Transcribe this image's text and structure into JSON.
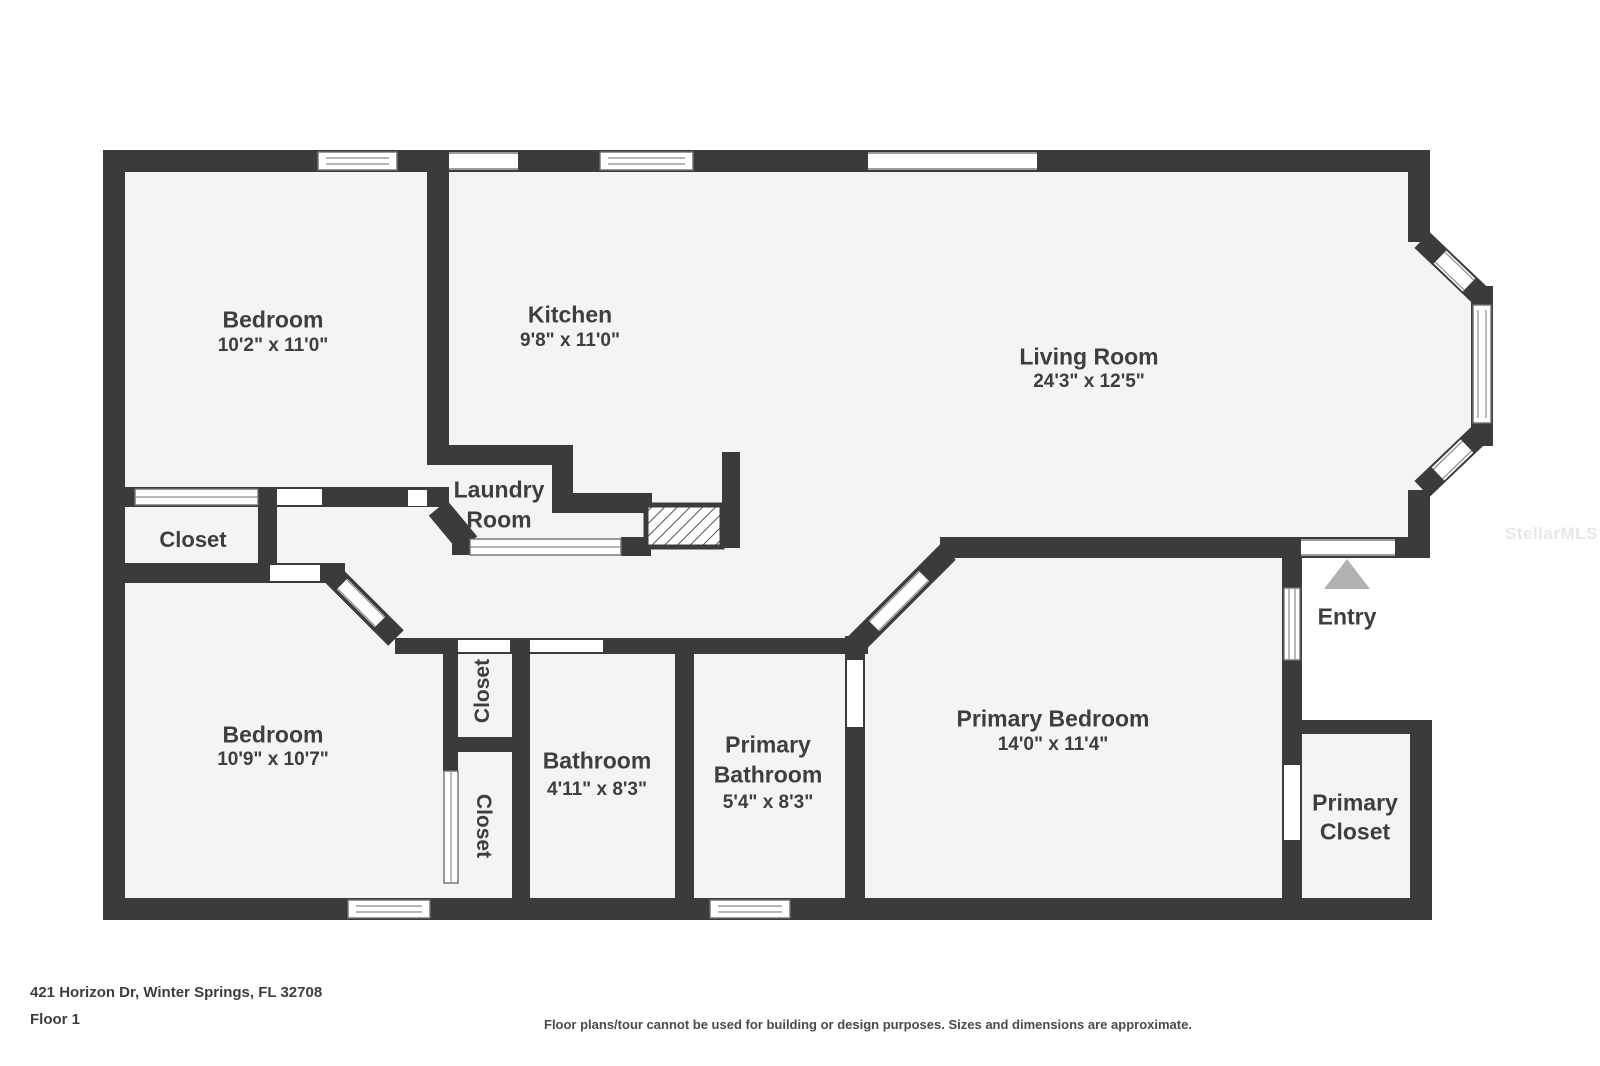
{
  "plan": {
    "rooms": {
      "bedroom1": {
        "name": "Bedroom",
        "dims": "10'2\" x 11'0\""
      },
      "kitchen": {
        "name": "Kitchen",
        "dims": "9'8\" x 11'0\""
      },
      "living_room": {
        "name": "Living Room",
        "dims": "24'3\" x 12'5\""
      },
      "laundry": {
        "line1": "Laundry",
        "line2": "Room"
      },
      "closet_hall": {
        "name": "Closet"
      },
      "bedroom2": {
        "name": "Bedroom",
        "dims": "10'9\" x 10'7\""
      },
      "closet_upper": {
        "name": "Closet"
      },
      "closet_lower": {
        "name": "Closet"
      },
      "bathroom": {
        "name": "Bathroom",
        "dims": "4'11\" x 8'3\""
      },
      "primary_bathroom": {
        "line1": "Primary",
        "line2": "Bathroom",
        "dims": "5'4\" x 8'3\""
      },
      "primary_bedroom": {
        "name": "Primary Bedroom",
        "dims": "14'0\" x 11'4\""
      },
      "primary_closet": {
        "line1": "Primary",
        "line2": "Closet"
      },
      "entry": {
        "name": "Entry"
      }
    },
    "watermark": "StellarMLS",
    "footer": {
      "address": "421 Horizon Dr, Winter Springs, FL 32708",
      "floor": "Floor 1",
      "disclaimer": "Floor plans/tour cannot be used for building or design purposes. Sizes and dimensions are approximate."
    },
    "colors": {
      "wall": "#3b3b3d",
      "floor": "#f4f4f5",
      "label_text": "#3e3e40",
      "entry_triangle": "#b1b1b4",
      "watermark": "#e7e7e9"
    }
  }
}
